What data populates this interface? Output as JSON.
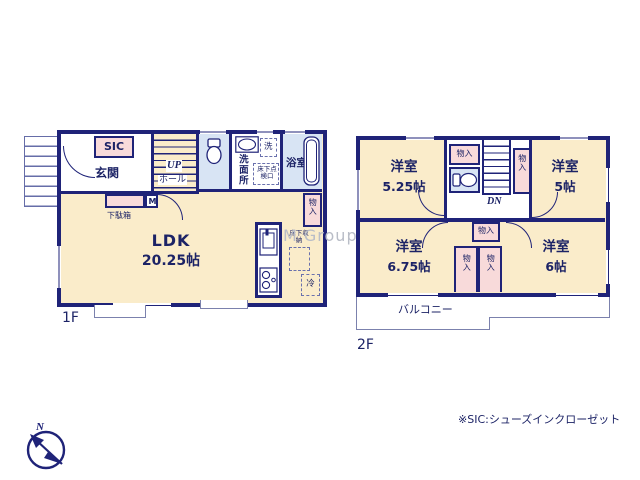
{
  "note": "※SIC:シューズインクローゼット",
  "watermark": "M Group",
  "compass": {
    "north": "N"
  },
  "floor1": {
    "label": "1F",
    "sic": "SIC",
    "entrance": "玄関",
    "stairs_up": "UP",
    "hall": "ホール",
    "washroom": "洗面所",
    "washer": "洗",
    "floor_hatch": "床下点検口",
    "bath": "浴室",
    "closet": "物入",
    "shoe_box": "下駄箱",
    "meter": "M",
    "ldk": "LDK",
    "ldk_size": "20.25帖",
    "floor_storage": "床下収納",
    "fridge": "冷"
  },
  "floor2": {
    "label": "2F",
    "room": "洋室",
    "room1_size": "5.25帖",
    "room2_size": "5帖",
    "room3_size": "6.75帖",
    "room4_size": "6帖",
    "closet": "物入",
    "stairs_down": "DN",
    "balcony": "バルコニー"
  },
  "colors": {
    "wall": "#1f2378",
    "room_cream": "#faecca",
    "closet_pink": "#f8dada",
    "wet_blue": "#d8e4f4",
    "text": "#1c2366"
  }
}
